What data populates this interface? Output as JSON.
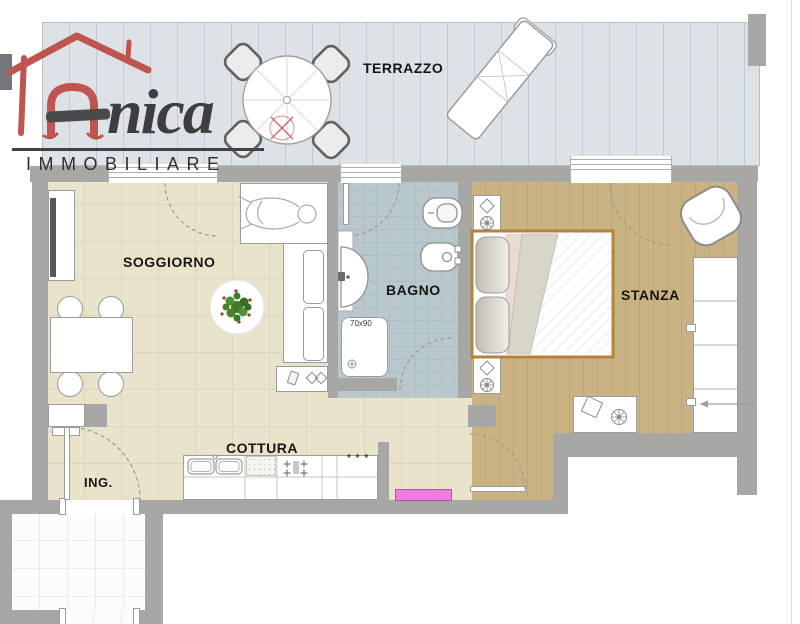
{
  "brand": {
    "initial": "A",
    "name_rest": "nica",
    "subtitle": "IMMOBILIARE",
    "accent_color": "#c0504d",
    "ink_color": "#3e3e40"
  },
  "rooms": {
    "terrazzo": {
      "label": "TERRAZZO",
      "floor_color": "#d2d8de"
    },
    "soggiorno": {
      "label": "SOGGIORNO",
      "floor_color": "#eae3cc"
    },
    "bagno": {
      "label": "BAGNO",
      "floor_color": "#b9c8cc"
    },
    "stanza": {
      "label": "STANZA",
      "floor_color": "#c9b383"
    },
    "cottura": {
      "label": "COTTURA"
    },
    "ingresso": {
      "label": "ING."
    }
  },
  "annotations": {
    "shower_size": "70x90",
    "freezer_symbol": "* * *"
  },
  "palette": {
    "wall": "#a7a7a5",
    "radiator": "#ec7ce0",
    "stairwell_floor": "#fcfcfc"
  }
}
